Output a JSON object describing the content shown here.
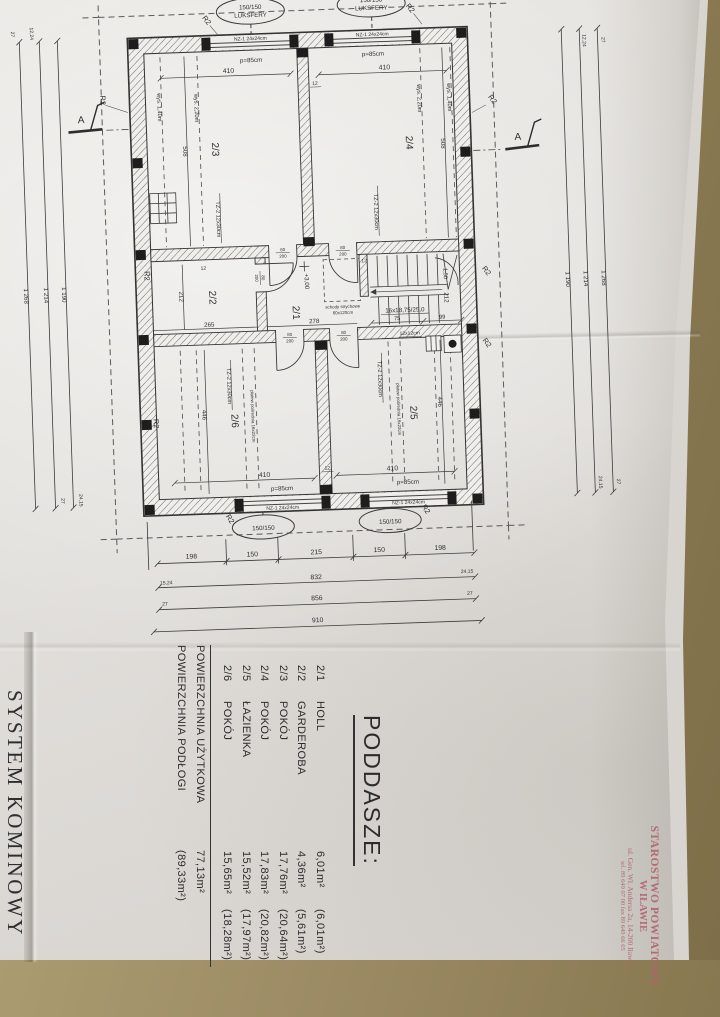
{
  "side_page": {
    "heading": "SYSTEM KOMINOWY"
  },
  "stamp": {
    "line1": "STAROSTWO POWIATOWE",
    "line2": "W IŁAWIE",
    "line3": "ul. Gen. Wł. Andersa 2a, 14-200 Iława",
    "line4": "tel. 89 649 07 00  fax 89 649 66 05"
  },
  "legend": {
    "title": "PODDASZE:",
    "rows": [
      {
        "no": "2/1",
        "name": "HOLL",
        "area": "6,01m²",
        "floor": "(6,01m²)"
      },
      {
        "no": "2/2",
        "name": "GARDEROBA",
        "area": "4,36m²",
        "floor": "(5,61m²)"
      },
      {
        "no": "2/3",
        "name": "POKÓJ",
        "area": "17,76m²",
        "floor": "(20,64m²)"
      },
      {
        "no": "2/4",
        "name": "POKÓJ",
        "area": "17,83m²",
        "floor": "(20,82m²)"
      },
      {
        "no": "2/5",
        "name": "ŁAZIENKA",
        "area": "15,52m²",
        "floor": "(17,97m²)"
      },
      {
        "no": "2/6",
        "name": "POKÓJ",
        "area": "15,65m²",
        "floor": "(18,28m²)"
      }
    ],
    "totals": [
      {
        "label": "POWIERZCHNIA UŻYTKOWA",
        "value": "77,13m²"
      },
      {
        "label": "POWIERZCHNIA PODŁOGI",
        "value": "(89,33m²)"
      }
    ]
  },
  "plan": {
    "section_marker": "A",
    "corner_label": "R2",
    "glass_block": {
      "size": "150/150",
      "name": "LUKSFERY"
    },
    "window": {
      "lintel": "NZ-1 24x24cm",
      "sill": "p=85cm",
      "width": "410"
    },
    "rooms": {
      "hall": "2/1",
      "wardrobe": "2/2",
      "room3": "2/3",
      "room4": "2/4",
      "bath": "2/5",
      "room6": "2/6"
    },
    "heights": {
      "h140": "wys. 1,40m",
      "h220": "wys. 2,20m"
    },
    "beam": "TZ-2 12x30cm",
    "purlin": "płatew pośrednia 16x22cm",
    "attic_stairs": {
      "line1": "schody strychowe",
      "line2": "60x120cm"
    },
    "stairs": {
      "spec": "16x18,75/25,0",
      "run1": "75",
      "run2": "99",
      "level": "1,50"
    },
    "level": "+3,00",
    "door": {
      "w": "80",
      "h": "200"
    },
    "chimney": "12x12cm",
    "dims": {
      "d508": "508",
      "d446": "446",
      "d212": "212",
      "d265": "265",
      "d278": "278",
      "d12": "12"
    }
  },
  "dim_chains": {
    "bottom": {
      "segments": [
        "198",
        "150",
        "215",
        "150",
        "198"
      ],
      "total1": "832",
      "total2": "856",
      "total3": "910",
      "end_left1": "15,24",
      "end_right1": "24,15",
      "end_left2": "27",
      "end_right2": "27"
    },
    "side": {
      "total1": "1 190",
      "total2": "1 214",
      "total3": "1 268",
      "end_top1": "12,24",
      "end_top2": "27",
      "end_bot1": "24,15",
      "end_bot2": "27"
    }
  }
}
